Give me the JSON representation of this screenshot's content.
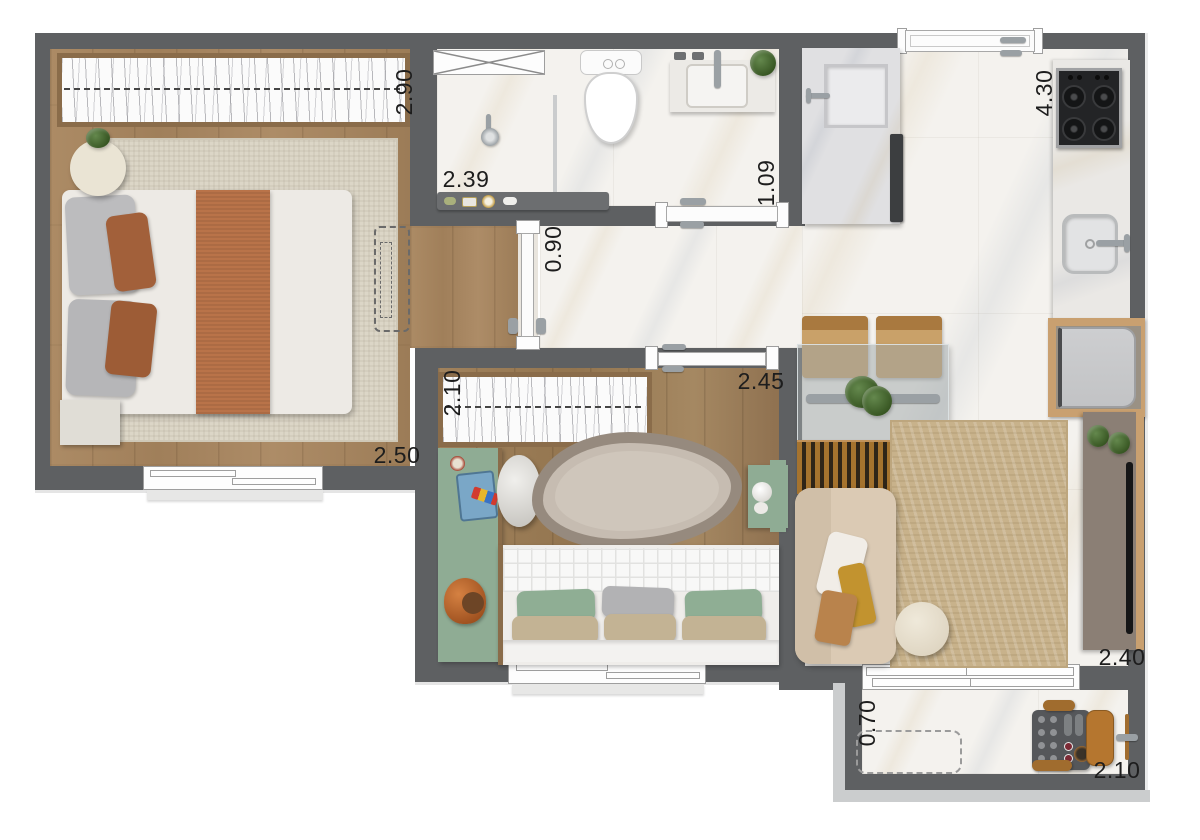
{
  "title": "apartment-floor-plan",
  "dimensions": {
    "master_depth": "2.90",
    "shower_width": "2.39",
    "bath_entry": "1.09",
    "hall_door": "0.90",
    "master_width": "2.50",
    "kids_depth": "2.10",
    "kids_width": "2.45",
    "kitchen_length": "4.30",
    "living_width": "2.40",
    "balcony_depth": "0.70",
    "balcony_width": "2.10"
  },
  "colors": {
    "wall": "#5e6062",
    "wood_floor": "#a8865f",
    "marble_floor": "#f4f2ee",
    "accent_green": "#8fac94",
    "copper": "#b97349",
    "master_rug": "#dcd6c7",
    "living_rug": "#cab289",
    "sofa": "#dbcab4",
    "tv_console": "#8b7f75",
    "counter_wood": "#c9a070",
    "label_text": "#1d1d1d"
  },
  "icons": {
    "bed": "double-bed",
    "wardrobe": "sliding-wardrobe",
    "toilet": "toilet",
    "sink": "sink",
    "shower": "shower-head",
    "cooktop": "gas-cooktop",
    "sofa": "sofa",
    "tv": "tv",
    "grill": "barbecue-cart"
  }
}
